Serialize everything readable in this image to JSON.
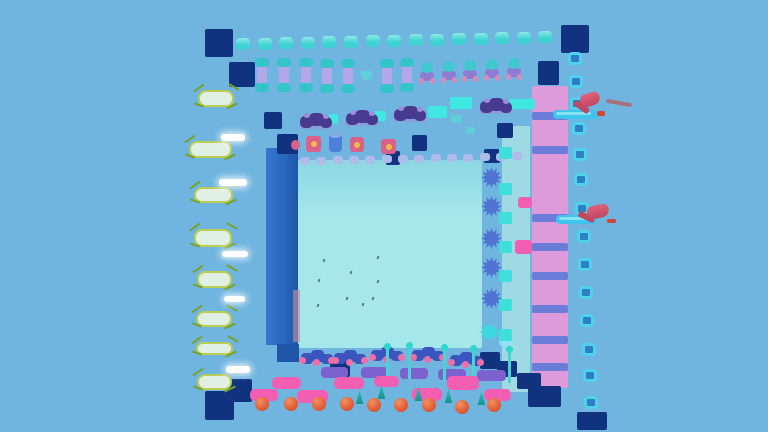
{
  "meta": {
    "type": "game-screenshot",
    "description": "Top-down aerial view of a colorful 3D obstacle-course (obby) game map floating on a light blue void"
  },
  "palette": {
    "background": "#70B5DF",
    "platform": "#A6E7EC",
    "platform_top": "#8BD7E1",
    "navy": "#11327F",
    "blue_col_light": "#3578CE",
    "blue_col": "#2A67BE",
    "blue_col_dark": "#1F56A8",
    "pink_col": "#DD9BDC",
    "rung": "#5E7AD8",
    "strip": "#9FD9E3",
    "tile": "#3FE0DC",
    "tile_border": "#4FD2EC",
    "tile_fill": "#2E7FC4",
    "bump": "#3ED2D2",
    "bump_hi": "#8FE9E6",
    "pill_body": "#B3A6E9",
    "pill_cap": "#35C4CA",
    "mush_head": "#3FC9CE",
    "mush_legs": "#8F7BD2",
    "mush_pink": "#D88BB8",
    "spider": "#473A8F",
    "spider_lt": "#9C8FD8",
    "pad": "#3FE8E0",
    "pad_dim": "#5FD0D8",
    "die": "#D96288",
    "die_dot": "#F0C040",
    "cyl": "#4B80D8",
    "cyl_top": "#82ABE8",
    "lav_bump": "#AFBCE9",
    "capsule": "#E0F0E2",
    "capsule_edge": "#B9CD55",
    "vine": "#76A22C",
    "white_bar": "#FFFFFF",
    "gear": "#4E73D0",
    "gear_cyan": "#3ED9E0",
    "flower_blue": "#3A55BE",
    "flower_pink": "#EE6FA8",
    "pinbar": "#7C62CE",
    "pin_stem": "#49D4D0",
    "pin_knob": "#2FD8CE",
    "pink_plat": "#F25FB2",
    "ball": "#E4603A",
    "ball_hi": "#F2925E",
    "ball_dark": "#C04E2A",
    "tree": "#17918E",
    "tree_hi": "#2FBFB4",
    "hammer": "#E0607A",
    "hammer_dark": "#C04860",
    "splash": "#3FC4EC",
    "splash_hi": "#8FE4F4",
    "debris": "#D83828",
    "speck": "#41626E",
    "shadow_pink": "#BD8FA6"
  },
  "scene": {
    "width": 768,
    "height": 432,
    "center_platform": [
      297,
      160,
      185,
      188
    ],
    "light_strip": [
      502,
      126,
      28,
      266
    ],
    "blue_column": [
      266,
      148,
      32,
      197
    ],
    "blue_step": [
      277,
      344,
      22,
      18
    ],
    "pink_shadow": [
      293,
      290,
      7,
      52
    ],
    "pink_ladder": {
      "rect": [
        532,
        86,
        36,
        302
      ],
      "rungs": [
        112,
        146,
        214,
        243,
        272,
        305,
        336,
        363
      ],
      "rung_h": 8
    },
    "pink_tabs": [
      [
        515,
        240,
        17,
        14
      ],
      [
        518,
        197,
        14,
        11
      ]
    ],
    "navy_blocks": [
      [
        205,
        29,
        28,
        28
      ],
      [
        229,
        62,
        26,
        25
      ],
      [
        264,
        112,
        18,
        17
      ],
      [
        277,
        134,
        21,
        20
      ],
      [
        412,
        135,
        15,
        16
      ],
      [
        386,
        151,
        14,
        14
      ],
      [
        497,
        123,
        16,
        15
      ],
      [
        484,
        149,
        16,
        14
      ],
      [
        538,
        61,
        21,
        24
      ],
      [
        561,
        25,
        28,
        28
      ],
      [
        227,
        379,
        25,
        23
      ],
      [
        205,
        391,
        29,
        29
      ],
      [
        330,
        358,
        20,
        19
      ],
      [
        480,
        352,
        20,
        17
      ],
      [
        497,
        361,
        20,
        16
      ],
      [
        517,
        373,
        24,
        16
      ],
      [
        528,
        386,
        33,
        21
      ],
      [
        577,
        412,
        30,
        18
      ]
    ],
    "cyan_bumps": [
      [
        236,
        38
      ],
      [
        258,
        38
      ],
      [
        279,
        37
      ],
      [
        301,
        37
      ],
      [
        322,
        36
      ],
      [
        344,
        36
      ],
      [
        366,
        35
      ],
      [
        387,
        35
      ],
      [
        409,
        34
      ],
      [
        430,
        34
      ],
      [
        452,
        33
      ],
      [
        474,
        33
      ],
      [
        495,
        32
      ],
      [
        517,
        32
      ],
      [
        538,
        31
      ]
    ],
    "pillars": [
      [
        257,
        61
      ],
      [
        279,
        61
      ],
      [
        301,
        61
      ],
      [
        322,
        62
      ],
      [
        343,
        62
      ],
      [
        382,
        62
      ],
      [
        402,
        61
      ]
    ],
    "small_u": [
      361,
      71,
      11,
      9
    ],
    "mushrooms": [
      [
        420,
        62
      ],
      [
        442,
        61
      ],
      [
        463,
        60
      ],
      [
        485,
        59
      ],
      [
        507,
        58
      ]
    ],
    "spiders": [
      [
        299,
        112
      ],
      [
        345,
        109
      ],
      [
        393,
        105
      ],
      [
        479,
        97
      ]
    ],
    "cyan_pads": [
      [
        325,
        114,
        13,
        10,
        0
      ],
      [
        373,
        111,
        13,
        10,
        0
      ],
      [
        428,
        106,
        19,
        12,
        0
      ],
      [
        450,
        97,
        22,
        12,
        0
      ],
      [
        451,
        115,
        11,
        8,
        1
      ],
      [
        509,
        99,
        26,
        10,
        0
      ],
      [
        466,
        127,
        9,
        7,
        1
      ]
    ],
    "dice": [
      [
        306,
        136,
        15,
        16
      ],
      [
        350,
        137,
        14,
        15
      ],
      [
        381,
        139,
        15,
        15
      ]
    ],
    "cylinder": [
      329,
      133,
      13,
      19
    ],
    "pink_dot": [
      291,
      140,
      9,
      10
    ],
    "lavender_bumps": [
      [
        300,
        157
      ],
      [
        316,
        157
      ],
      [
        333,
        156
      ],
      [
        349,
        156
      ],
      [
        365,
        156
      ],
      [
        382,
        155
      ],
      [
        398,
        155
      ],
      [
        414,
        155
      ],
      [
        431,
        154
      ],
      [
        447,
        154
      ],
      [
        463,
        154
      ],
      [
        480,
        153
      ],
      [
        496,
        153
      ],
      [
        512,
        152
      ]
    ],
    "capsules": [
      [
        198,
        90,
        36,
        17
      ],
      [
        189,
        141,
        43,
        17
      ],
      [
        194,
        187,
        39,
        16
      ],
      [
        194,
        229,
        38,
        18
      ],
      [
        197,
        271,
        35,
        17
      ],
      [
        196,
        311,
        36,
        16
      ],
      [
        196,
        342,
        37,
        13
      ],
      [
        197,
        374,
        35,
        16
      ]
    ],
    "white_bars": [
      [
        221,
        134,
        24,
        7
      ],
      [
        219,
        179,
        28,
        7
      ],
      [
        222,
        251,
        26,
        6
      ],
      [
        224,
        296,
        21,
        6
      ],
      [
        226,
        366,
        24,
        7
      ]
    ],
    "gears": [
      [
        481,
        167
      ],
      [
        481,
        196
      ],
      [
        481,
        228
      ],
      [
        481,
        257
      ],
      [
        481,
        288
      ]
    ],
    "gear_cyan": [
      479,
      323,
      21,
      18
    ],
    "cyan_glow": [
      499,
      337,
      13,
      9
    ],
    "cyan_tiles": [
      [
        499,
        147
      ],
      [
        499,
        183
      ],
      [
        499,
        212
      ],
      [
        499,
        241
      ],
      [
        499,
        270
      ],
      [
        499,
        299
      ],
      [
        499,
        329
      ]
    ],
    "outline_squares": [
      [
        568,
        52
      ],
      [
        569,
        75
      ],
      [
        570,
        97
      ],
      [
        572,
        122
      ],
      [
        573,
        148
      ],
      [
        574,
        173
      ],
      [
        575,
        202
      ],
      [
        577,
        230
      ],
      [
        578,
        258
      ],
      [
        579,
        286
      ],
      [
        580,
        314
      ],
      [
        582,
        343
      ],
      [
        583,
        369
      ],
      [
        584,
        396
      ]
    ],
    "flowers": [
      [
        301,
        350
      ],
      [
        334,
        350
      ],
      [
        371,
        347
      ],
      [
        412,
        347
      ],
      [
        450,
        352
      ]
    ],
    "pin_bars": [
      [
        321,
        367,
        27,
        11
      ],
      [
        361,
        367,
        27,
        11
      ],
      [
        400,
        368,
        28,
        11
      ],
      [
        438,
        369,
        28,
        11
      ],
      [
        477,
        370,
        29,
        11
      ]
    ],
    "pins": [
      [
        384,
        343
      ],
      [
        406,
        342
      ],
      [
        441,
        344
      ],
      [
        470,
        345
      ],
      [
        506,
        346
      ]
    ],
    "pink_platforms": [
      [
        272,
        377,
        29,
        12
      ],
      [
        334,
        377,
        30,
        12
      ],
      [
        374,
        376,
        25,
        11
      ],
      [
        447,
        376,
        32,
        14
      ],
      [
        250,
        389,
        28,
        12
      ],
      [
        297,
        390,
        31,
        13
      ],
      [
        412,
        388,
        30,
        13
      ],
      [
        484,
        389,
        27,
        12
      ]
    ],
    "orange_balls": [
      [
        255,
        397
      ],
      [
        284,
        397
      ],
      [
        312,
        397
      ],
      [
        340,
        397
      ],
      [
        367,
        398
      ],
      [
        394,
        398
      ],
      [
        422,
        398
      ],
      [
        455,
        400
      ],
      [
        487,
        398
      ]
    ],
    "trees": [
      [
        355,
        390
      ],
      [
        377,
        385
      ],
      [
        414,
        387
      ],
      [
        444,
        389
      ],
      [
        477,
        391
      ]
    ],
    "hammers": [
      {
        "head": [
          580,
          93,
          20,
          13
        ],
        "head_rot": -18,
        "handle": [
          573,
          104,
          17,
          6
        ],
        "handle_rot": 35,
        "splash": [
          553,
          110,
          45,
          9
        ],
        "debris": [
          597,
          111,
          8,
          5
        ],
        "streak": [
          606,
          101,
          26,
          4
        ],
        "streak_rot": 10
      },
      {
        "head": [
          587,
          205,
          22,
          13
        ],
        "head_rot": -12,
        "handle": [
          578,
          214,
          17,
          6
        ],
        "handle_rot": 25,
        "splash": [
          556,
          215,
          41,
          9
        ],
        "debris": [
          607,
          219,
          9,
          4
        ],
        "streak": null,
        "streak_rot": 0
      }
    ],
    "specks": [
      [
        323,
        259
      ],
      [
        377,
        256
      ],
      [
        350,
        271
      ],
      [
        318,
        279
      ],
      [
        377,
        280
      ],
      [
        346,
        297
      ],
      [
        372,
        297
      ],
      [
        317,
        304
      ],
      [
        362,
        303
      ]
    ]
  }
}
